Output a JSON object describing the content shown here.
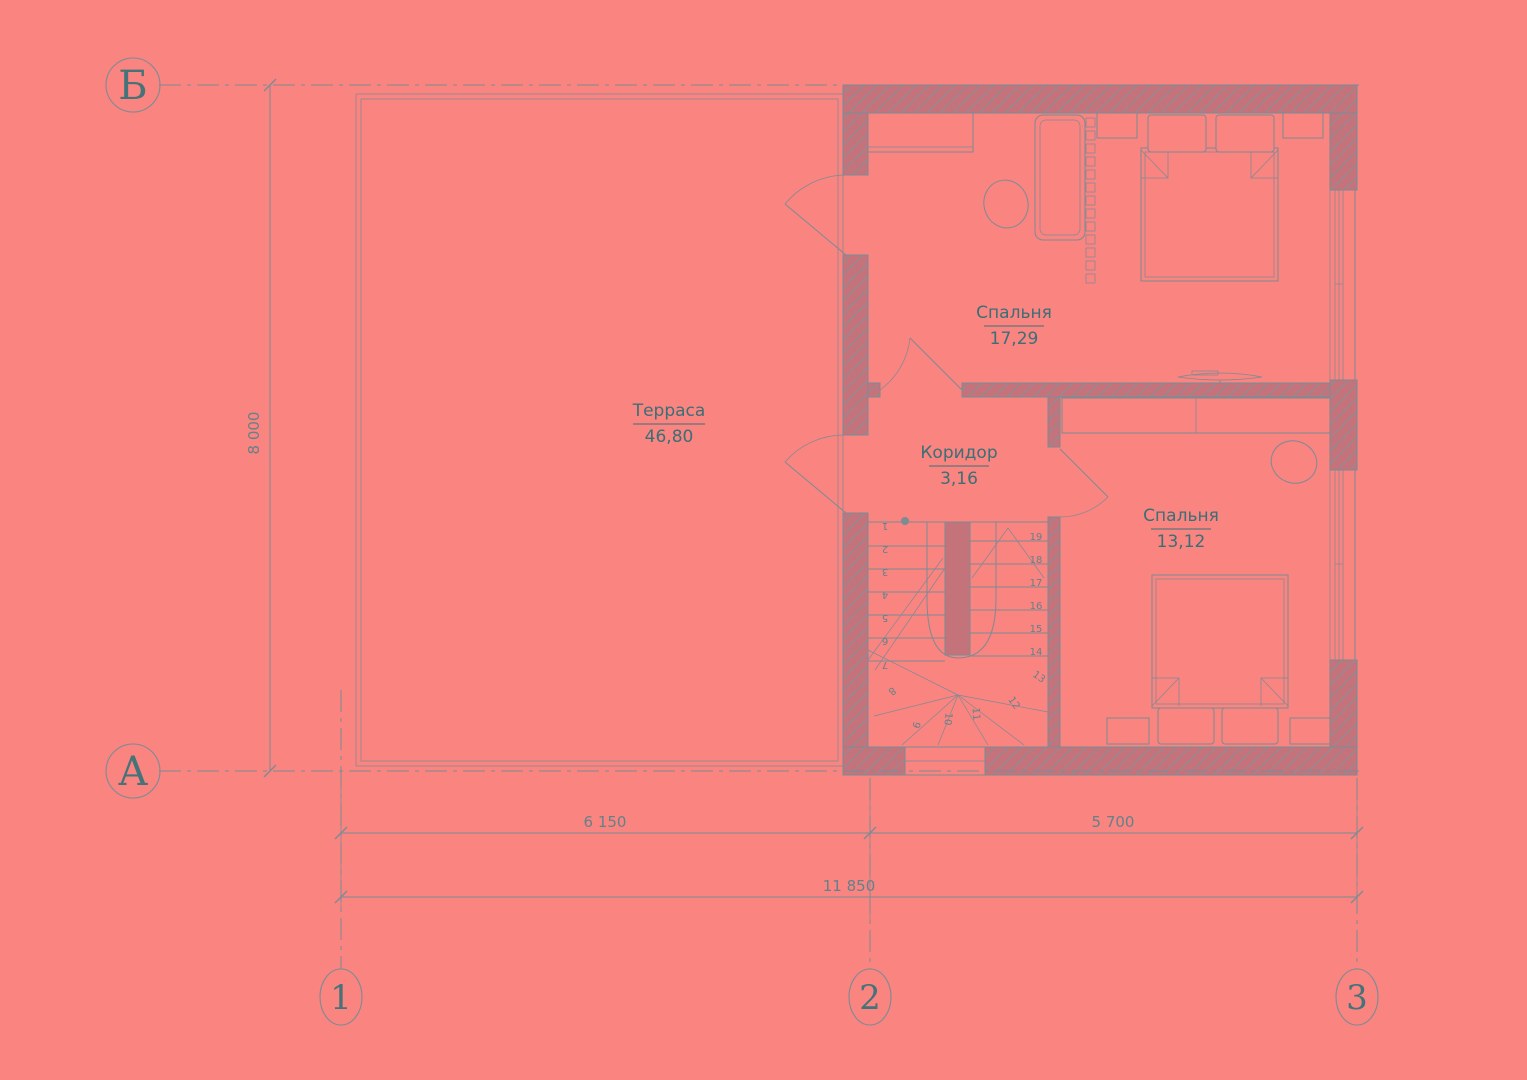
{
  "colors": {
    "bg": "#f98480",
    "wall": "#c4737b",
    "line": "#7d8b94",
    "hatch": "#84909c",
    "room_text": "#3b6f77",
    "axis_text": "#457379",
    "dim_text": "#64818a"
  },
  "rooms": {
    "terrace": {
      "name": "Терраса",
      "area": "46,80"
    },
    "bedroom1": {
      "name": "Спальня",
      "area": "17,29"
    },
    "corridor": {
      "name": "Коридор",
      "area": "3,16"
    },
    "bedroom2": {
      "name": "Спальня",
      "area": "13,12"
    }
  },
  "dimensions": {
    "span_left": "6 150",
    "span_right": "5 700",
    "total": "11 850",
    "height": "8 000"
  },
  "axes": {
    "rows": [
      {
        "label": "Б"
      },
      {
        "label": "А"
      }
    ],
    "cols": [
      {
        "label": "1"
      },
      {
        "label": "2"
      },
      {
        "label": "3"
      }
    ]
  },
  "stairs": {
    "steps": [
      "1",
      "2",
      "3",
      "4",
      "5",
      "6",
      "7",
      "8",
      "9",
      "10",
      "11",
      "12",
      "13",
      "14",
      "15",
      "16",
      "17",
      "18",
      "19"
    ]
  }
}
